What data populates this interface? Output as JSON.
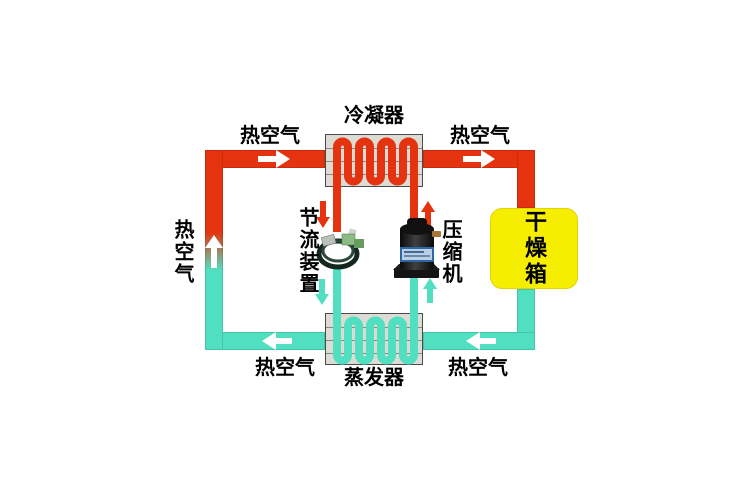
{
  "diagram": {
    "components": {
      "condenser": {
        "label": "冷凝器"
      },
      "evaporator": {
        "label": "蒸发器"
      },
      "throttle_device": {
        "label": "节流装置"
      },
      "compressor": {
        "label": "压缩机"
      },
      "drying_box": {
        "label": "干燥箱"
      }
    },
    "air_labels": {
      "top_left": "热空气",
      "top_right": "热空气",
      "bottom_left": "热空气",
      "bottom_right": "热空气",
      "left_side": "热空气"
    },
    "colors": {
      "hot_pipe": "#e5330f",
      "cool_pipe": "#50dfc0",
      "drying_box_fill": "#f6ee00",
      "exchanger_fill": "#dcdcd4",
      "exchanger_border": "#4a4a4a",
      "label_text": "#000000",
      "flow_arrow": "#ffffff"
    },
    "icons": {
      "flow_right_icon": "▶",
      "flow_left_icon": "◀",
      "flow_up_icon": "▲",
      "flow_down_icon": "▼"
    }
  }
}
